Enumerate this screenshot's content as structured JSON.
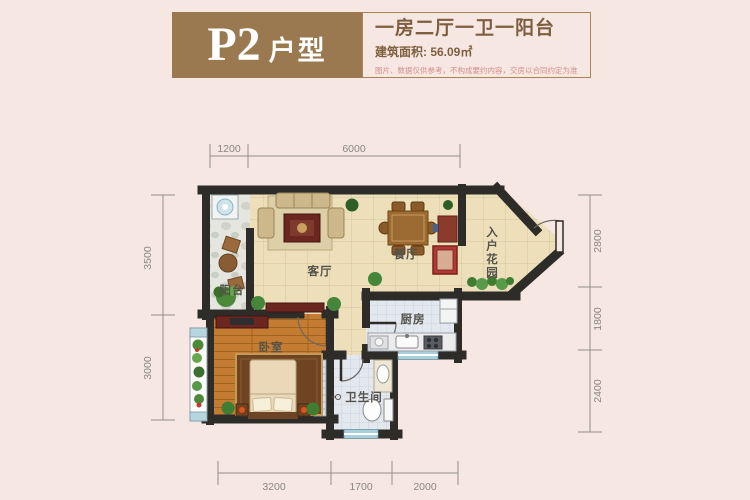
{
  "header": {
    "unit_code": "P2",
    "unit_type_suffix": "户型",
    "title": "一房二厅一卫一阳台",
    "area": "建筑面积: 56.09㎡",
    "disclaimer": "图片、数据仅供参考，不构成要约内容，交房以合同约定为准"
  },
  "plan": {
    "rooms": {
      "balcony": "阳台",
      "living": "客厅",
      "dining": "餐厅",
      "entry_garden": "入户花园",
      "kitchen": "厨房",
      "bedroom": "卧室",
      "bathroom": "卫生间"
    },
    "dims": {
      "top": [
        "1200",
        "6000"
      ],
      "left": [
        "3500",
        "3000"
      ],
      "right": [
        "2800",
        "1800",
        "2400"
      ],
      "bottom": [
        "3200",
        "1700",
        "2000"
      ]
    },
    "colors": {
      "background": "#f7e7e2",
      "accent_brown": "#9a7950",
      "wall": "#2e2c29",
      "floor_tile": "#ecdfba",
      "wood_floor": "#c37c32",
      "wet_tile": "#e3e7ee",
      "window_blue": "#a9cfdd",
      "disclaimer_pink": "#d4908b"
    }
  }
}
